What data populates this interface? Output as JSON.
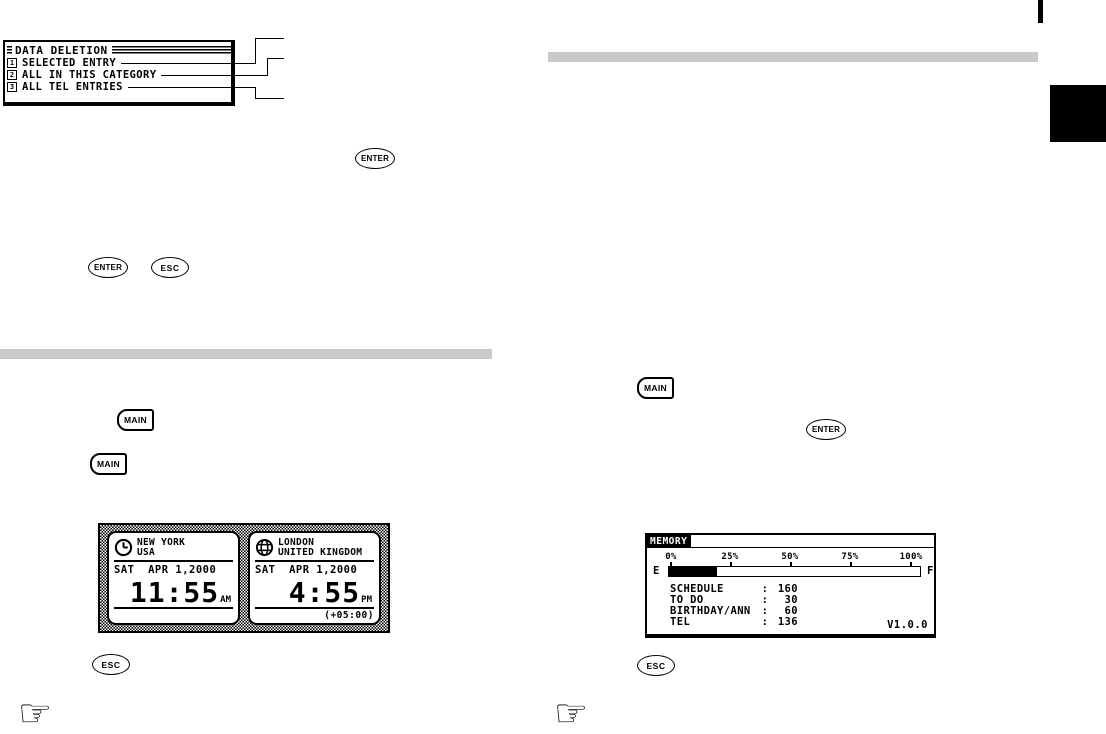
{
  "lcd_menu": {
    "title": "DATA DELETION",
    "items": [
      {
        "num": "1",
        "label": "SELECTED ENTRY"
      },
      {
        "num": "2",
        "label": "ALL IN THIS CATEGORY"
      },
      {
        "num": "3",
        "label": "ALL TEL ENTRIES"
      }
    ]
  },
  "buttons": {
    "enter": "ENTER",
    "esc": "ESC",
    "main": "MAIN"
  },
  "clock_screen": {
    "left": {
      "city": "NEW YORK",
      "country": "USA",
      "date": "SAT  APR 1,2000",
      "time": "11:55",
      "meridiem": "AM"
    },
    "right": {
      "city": "LONDON",
      "country": "UNITED KINGDOM",
      "date": "SAT  APR 1,2000",
      "time": "4:55",
      "meridiem": "PM",
      "offset": "(+05:00)"
    }
  },
  "memory_screen": {
    "title": "MEMORY",
    "scale_labels": [
      "0%",
      "25%",
      "50%",
      "75%",
      "100%"
    ],
    "gauge": {
      "left_label": "E",
      "right_label": "F",
      "fill_percent": "19%"
    },
    "colon": ":",
    "entries": [
      {
        "label": "SCHEDULE",
        "value": "160"
      },
      {
        "label": "TO DO",
        "value": "30"
      },
      {
        "label": "BIRTHDAY/ANN",
        "value": "60"
      },
      {
        "label": "TEL",
        "value": "136"
      }
    ],
    "version": "V1.0.0"
  },
  "icons": {
    "manicule": "☞"
  },
  "colors": {
    "section_bar": "#c9c9c9",
    "ink": "#000000"
  }
}
